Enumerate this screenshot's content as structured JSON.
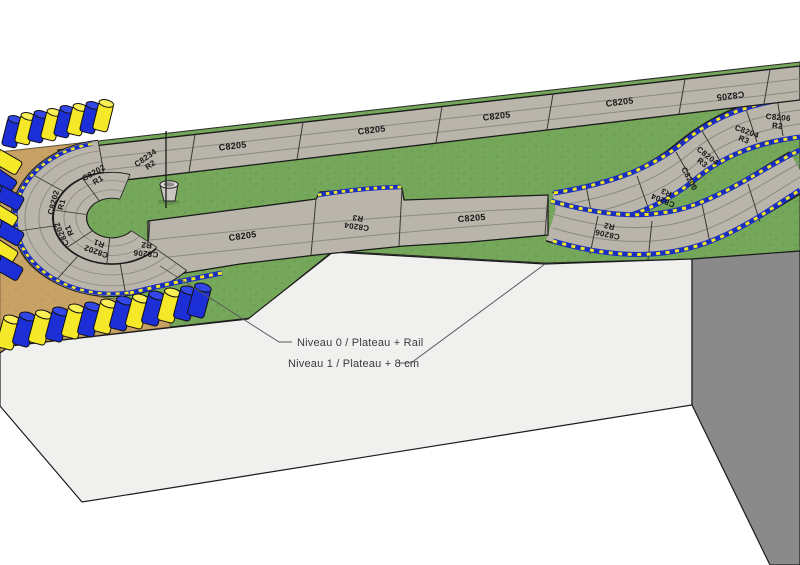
{
  "scene": {
    "type": "3d-model-viewport",
    "description": "Slot car track plan on two-level baseboard"
  },
  "annotations": {
    "level0": "Niveau 0 / Plateau + Rail",
    "level1": "Niveau 1 / Plateau + 8 cm"
  },
  "track": {
    "pieces": [
      {
        "code": "C8205",
        "radius": ""
      },
      {
        "code": "C8205",
        "radius": ""
      },
      {
        "code": "C8205",
        "radius": ""
      },
      {
        "code": "C8205",
        "radius": ""
      },
      {
        "code": "C8205",
        "radius": ""
      },
      {
        "code": "C8206",
        "radius": "R2"
      },
      {
        "code": "C8204",
        "radius": "R3"
      },
      {
        "code": "C8204",
        "radius": "R3"
      },
      {
        "code": "C8200",
        "radius": ""
      },
      {
        "code": "C8204",
        "radius": "R3"
      },
      {
        "code": "C8206",
        "radius": "R2"
      },
      {
        "code": "C8205",
        "radius": ""
      },
      {
        "code": "C8204",
        "radius": "R3"
      },
      {
        "code": "C8205",
        "radius": ""
      },
      {
        "code": "C8234",
        "radius": "R2"
      },
      {
        "code": "C8202",
        "radius": "R1"
      },
      {
        "code": "C8202",
        "radius": "R1"
      },
      {
        "code": "C8202",
        "radius": "R1"
      },
      {
        "code": "C8202",
        "radius": "R1"
      },
      {
        "code": "C8206",
        "radius": "R2"
      }
    ]
  },
  "colors": {
    "background": "#FFFFFF",
    "grass": "#74A75A",
    "dirt": "#C8A265",
    "track": "#B9B5AB",
    "curb_blue": "#1B2FBF",
    "curb_yellow": "#F2E71F",
    "barrel_blue": "#1C2FD6",
    "barrel_blue_top": "#3347E8",
    "barrel_yellow": "#F5E829",
    "barrel_yellow_top": "#F8EF55",
    "face_front": "#F0F0EE",
    "face_side": "#8A8A8A"
  }
}
